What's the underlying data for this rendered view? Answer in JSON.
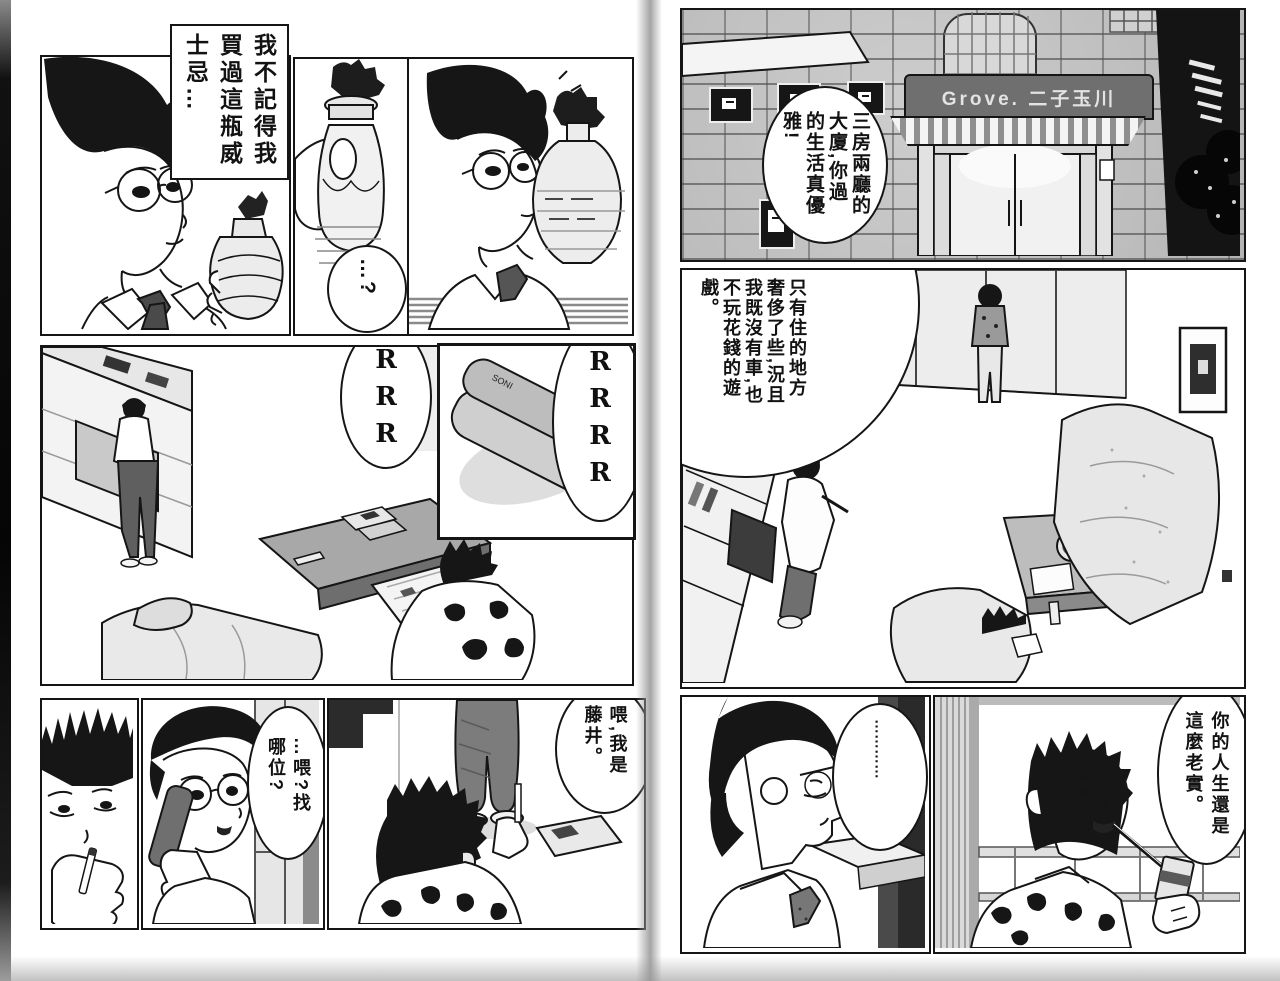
{
  "colors": {
    "ink": "#151515",
    "paper": "#ffffff",
    "tone_light": "#e6e6e6",
    "tone_mid": "#b5b5b5",
    "tone_dark": "#4a4a4a",
    "night": "#141414"
  },
  "left_page": {
    "speech": {
      "whisky": "我不記得我買過這瓶威士忌…",
      "question": "…?",
      "phone_hello": "…喂?找哪位?",
      "phone_fujii": "喂,我是藤井。"
    },
    "sfx": {
      "ring_small": "RRR",
      "ring_large": "RRRR"
    },
    "labels": {
      "phone_brand": "SONI"
    }
  },
  "right_page": {
    "speech": {
      "mansion": "三房兩廳的大廈,你過的生活真優雅!",
      "luxury": "只有住的地方奢侈了些,況且我既沒有車,也不玩花錢的遊戲。",
      "silence": "…………",
      "honest": "你的人生還是這麼老實。"
    },
    "labels": {
      "building_sign": "Grove. 二子玉川"
    }
  }
}
